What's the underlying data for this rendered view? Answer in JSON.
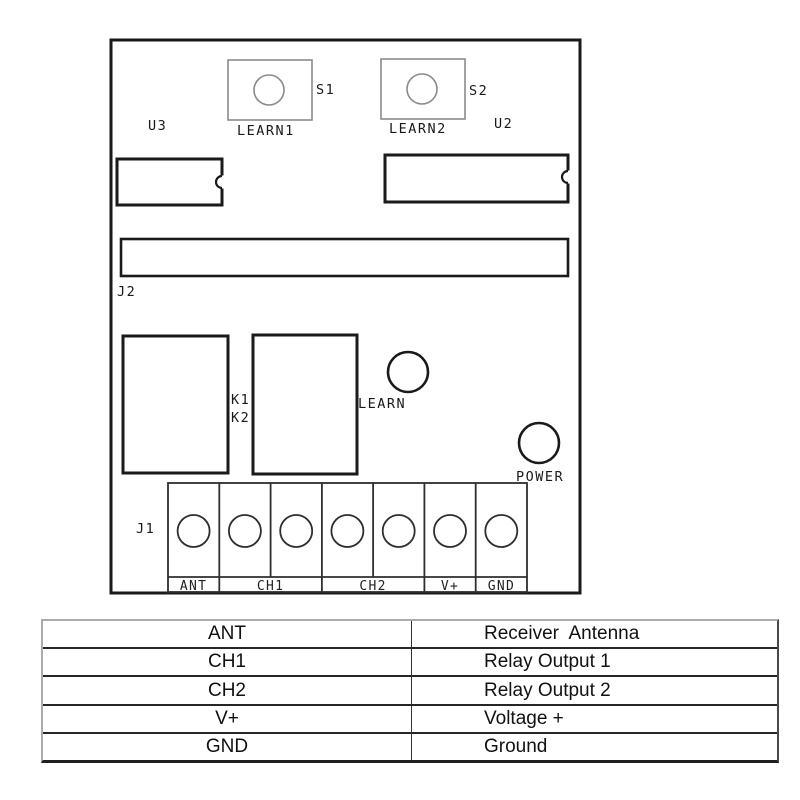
{
  "board": {
    "component_labels": {
      "u3": "U3",
      "u2": "U2",
      "s1": "S1",
      "s2": "S2",
      "learn1": "LEARN1",
      "learn2": "LEARN2",
      "j2": "J2",
      "k1": "K1",
      "k2": "K2",
      "learn": "LEARN",
      "power": "POWER",
      "j1": "J1"
    },
    "terminal_labels": [
      "ANT",
      "CH1",
      "CH2",
      "V+",
      "GND"
    ]
  },
  "pin_table": {
    "rows": [
      {
        "pin": "ANT",
        "description": "Receiver  Antenna"
      },
      {
        "pin": "CH1",
        "description": "Relay Output 1"
      },
      {
        "pin": "CH2",
        "description": "Relay Output 2"
      },
      {
        "pin": "V+",
        "description": "Voltage +"
      },
      {
        "pin": "GND",
        "description": "Ground"
      }
    ]
  },
  "colors": {
    "line_dark": "#1a1a1a",
    "line_light": "#8a8a8a",
    "background": "#ffffff"
  }
}
